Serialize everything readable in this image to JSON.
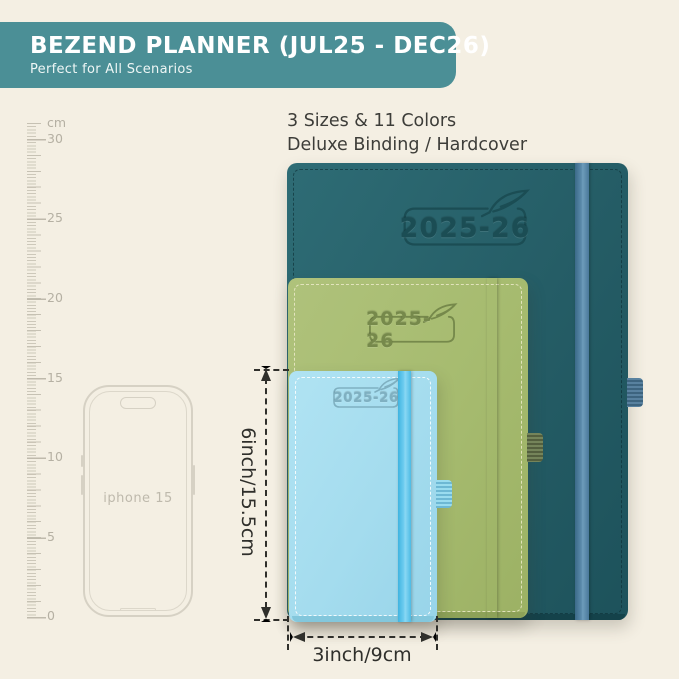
{
  "banner": {
    "title": "BEZEND PLANNER (JUL25 - DEC26)",
    "subtitle": "Perfect for All Scenarios",
    "bg_color": "#4b8f96",
    "text_color": "#ffffff"
  },
  "headline": {
    "line1": "3 Sizes & 11 Colors",
    "line2": "Deluxe Binding / Hardcover"
  },
  "ruler": {
    "unit": "cm",
    "labels": [
      "30",
      "25",
      "20",
      "15",
      "10",
      "5",
      "0"
    ]
  },
  "phone": {
    "label": "iphone 15"
  },
  "planners": {
    "large": {
      "year": "2025-26",
      "cover_color": "#255d66",
      "band_color": "#5b8aab"
    },
    "medium": {
      "year": "2025-26",
      "cover_color": "#a6bb6f",
      "band_color": "#6d7b50"
    },
    "small": {
      "year": "2025-26",
      "cover_color": "#a4dcee",
      "band_color": "#58c3e9"
    }
  },
  "dimensions": {
    "height": "6inch/15.5cm",
    "width": "3inch/9cm"
  },
  "background_color": "#f4efe3"
}
